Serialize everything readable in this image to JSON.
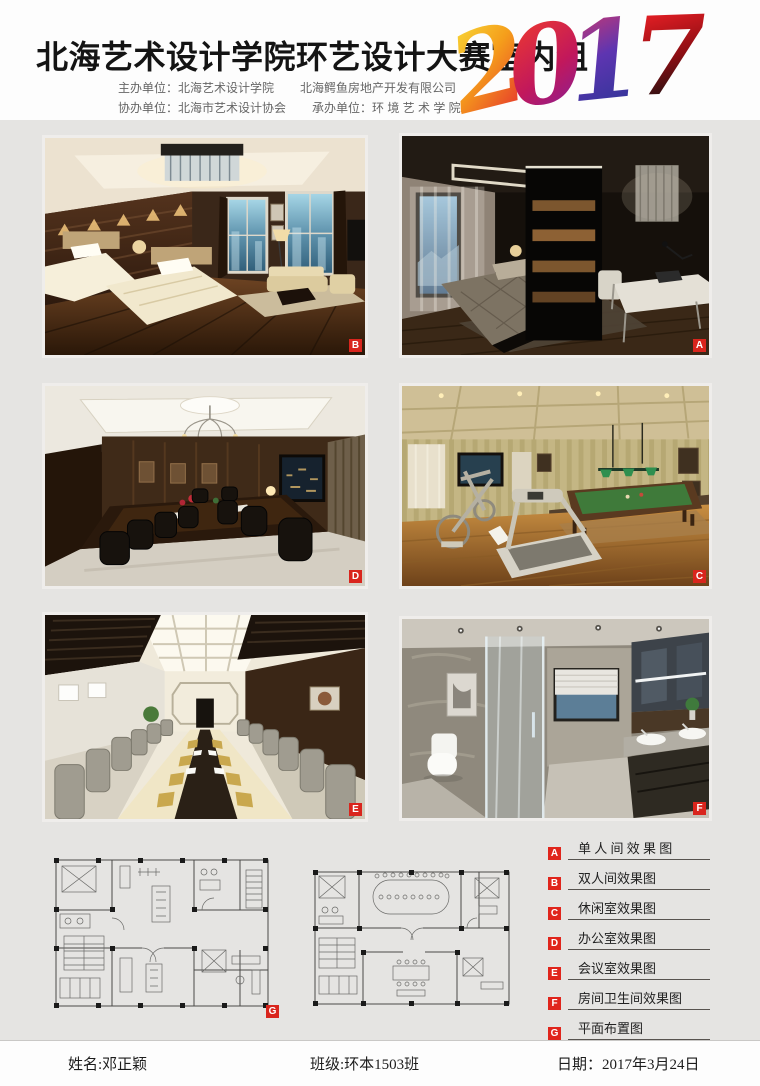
{
  "colors": {
    "background_gray": "#e5e4e2",
    "header_white": "#fdfdfd",
    "accent_red": "#d9251d"
  },
  "header": {
    "title": "北海艺术设计学院环艺设计大赛室内组",
    "year": [
      "2",
      "0",
      "1",
      "7"
    ],
    "org1a": "主办单位：北海艺术设计学院",
    "org1b": "北海鳄鱼房地产开发有限公司",
    "org2a": "协办单位：北海市艺术设计协会",
    "org2b": "承办单位：环 境 艺 术 学 院"
  },
  "gallery": [
    {
      "tag": "B"
    },
    {
      "tag": "A"
    },
    {
      "tag": "D"
    },
    {
      "tag": "C"
    },
    {
      "tag": "E"
    },
    {
      "tag": "F"
    }
  ],
  "plans": {
    "tag": "G"
  },
  "legend": [
    {
      "key": "A",
      "label": "单 人 间 效 果 图"
    },
    {
      "key": "B",
      "label": "双人间效果图"
    },
    {
      "key": "C",
      "label": "休闲室效果图"
    },
    {
      "key": "D",
      "label": "办公室效果图"
    },
    {
      "key": "E",
      "label": "会议室效果图"
    },
    {
      "key": "F",
      "label": "房间卫生间效果图"
    },
    {
      "key": "G",
      "label": "平面布置图"
    }
  ],
  "footer": {
    "name_label": "姓名:",
    "name_value": "邓正颖",
    "class_label": "班级:",
    "class_value": "环本1503班",
    "date_label": "日期：",
    "date_value": "2017年3月24日"
  }
}
